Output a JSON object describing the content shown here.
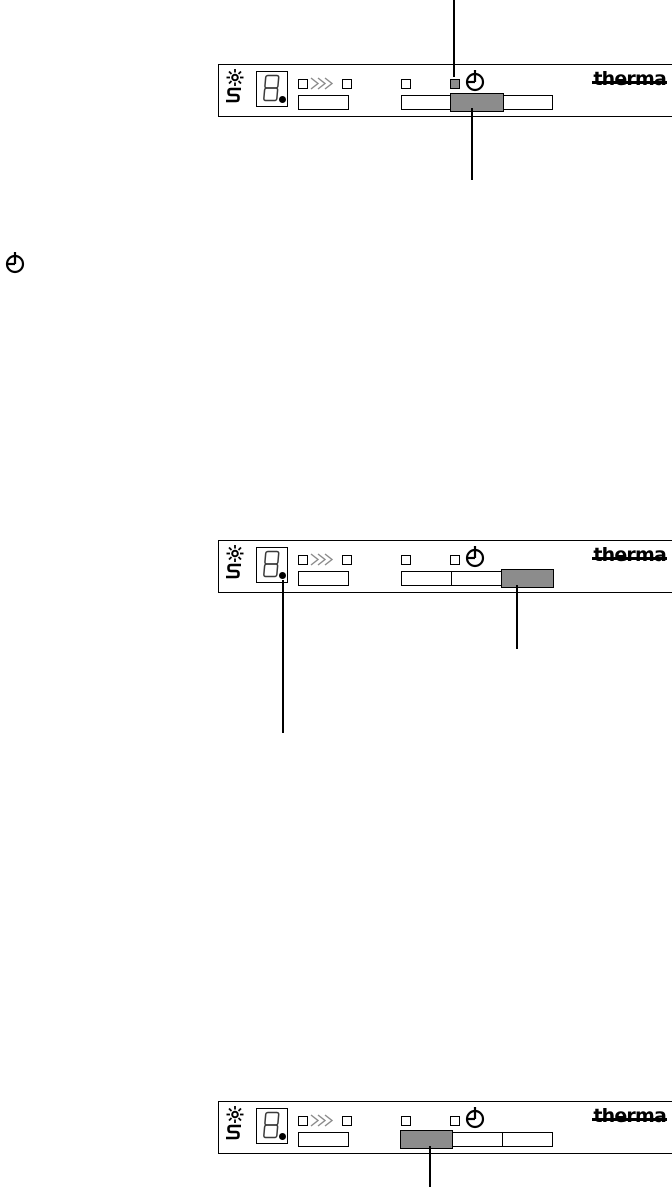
{
  "page": {
    "type": "appliance-manual-control-panel-diagrams",
    "background": "#ffffff"
  },
  "brand": {
    "logo": "therma"
  },
  "colors": {
    "line": "#000000",
    "active_fill": "#8c8c8c",
    "chevron": "#8a8a8a",
    "background": "#ffffff"
  },
  "icons": {
    "standalone": "delay-timer-clock-icon",
    "rinse_aid": "sun-icon",
    "salt": "s-curve-icon",
    "display_digit": "8",
    "speed": "triple-chevron-icon",
    "delay": "clock-icon"
  },
  "panels": [
    {
      "name": "panel-delay-led-active",
      "logo": "therma",
      "delay_led": "on",
      "segments": [
        "off",
        "on",
        "off"
      ],
      "display_dot": "on",
      "callouts": [
        "delay-led",
        "middle-progress-segment"
      ]
    },
    {
      "name": "panel-last-segment-active",
      "logo": "therma",
      "delay_led": "off",
      "segments": [
        "off",
        "off",
        "on"
      ],
      "display_dot": "on",
      "callouts": [
        "display-dot",
        "right-progress-segment"
      ]
    },
    {
      "name": "panel-first-segment-active",
      "logo": "therma",
      "delay_led": "off",
      "segments": [
        "on",
        "off",
        "off"
      ],
      "display_dot": "on",
      "callouts": [
        "left-progress-segment"
      ]
    }
  ]
}
